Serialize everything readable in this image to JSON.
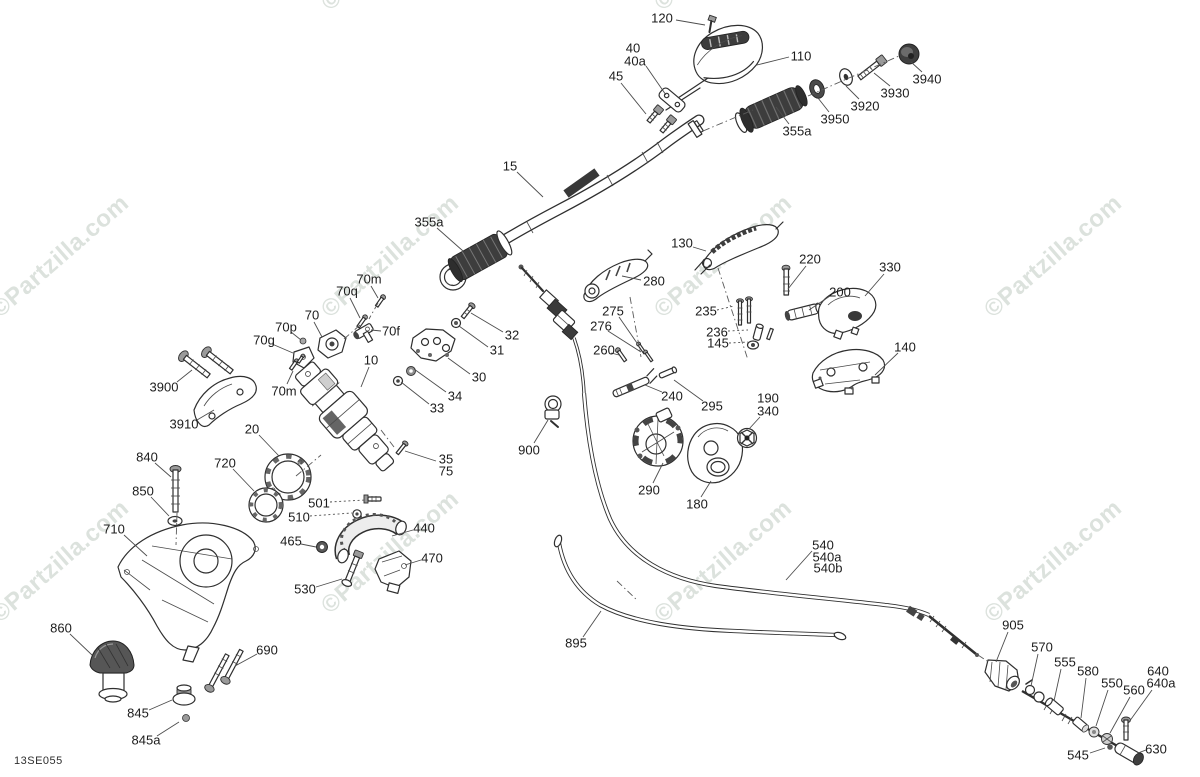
{
  "diagram": {
    "code": "13SE055",
    "title": "Steering system exploded parts diagram",
    "background_color": "#ffffff",
    "line_color": "#2f2f2f",
    "label_color": "#1c1c1c",
    "label_font_px": 13
  },
  "watermark": {
    "text": "©Partzilla.com",
    "color": "#c5cfc7",
    "opacity": 0.6,
    "rotation_deg": -41,
    "font_size": 24,
    "positions": [
      {
        "x": 395,
        "y": -45
      },
      {
        "x": 728,
        "y": -45
      },
      {
        "x": 65,
        "y": 262
      },
      {
        "x": 395,
        "y": 262
      },
      {
        "x": 728,
        "y": 262
      },
      {
        "x": 1058,
        "y": 262
      },
      {
        "x": 65,
        "y": 567
      },
      {
        "x": 395,
        "y": 558
      },
      {
        "x": 728,
        "y": 567
      },
      {
        "x": 1058,
        "y": 567
      }
    ]
  },
  "callouts": [
    {
      "label": "120",
      "x": 662,
      "y": 18,
      "leader": [
        676,
        20,
        705,
        25
      ]
    },
    {
      "label": "40",
      "x": 633,
      "y": 48
    },
    {
      "label": "40a",
      "x": 635,
      "y": 61,
      "leader": [
        646,
        66,
        666,
        95
      ]
    },
    {
      "label": "45",
      "x": 616,
      "y": 76,
      "leader": [
        621,
        83,
        646,
        114
      ]
    },
    {
      "label": "110",
      "x": 801,
      "y": 56,
      "leader": [
        789,
        57,
        757,
        65
      ]
    },
    {
      "label": "3940",
      "x": 927,
      "y": 79,
      "leader": [
        922,
        72,
        911,
        62
      ]
    },
    {
      "label": "3930",
      "x": 895,
      "y": 93,
      "leader": [
        890,
        86,
        874,
        73
      ]
    },
    {
      "label": "3920",
      "x": 865,
      "y": 106,
      "leader": [
        859,
        99,
        846,
        86
      ]
    },
    {
      "label": "3950",
      "x": 835,
      "y": 119,
      "leader": [
        829,
        112,
        818,
        98
      ]
    },
    {
      "label": "355a",
      "x": 797,
      "y": 131,
      "leader": [
        789,
        124,
        776,
        107
      ]
    },
    {
      "label": "15",
      "x": 510,
      "y": 166,
      "leader": [
        517,
        172,
        543,
        197
      ]
    },
    {
      "label": "355a",
      "x": 429,
      "y": 222,
      "leader": [
        437,
        228,
        463,
        251
      ]
    },
    {
      "label": "130",
      "x": 682,
      "y": 243,
      "leader": [
        693,
        247,
        706,
        251
      ]
    },
    {
      "label": "280",
      "x": 654,
      "y": 281,
      "leader": [
        641,
        280,
        622,
        276
      ]
    },
    {
      "label": "220",
      "x": 810,
      "y": 259,
      "leader": [
        806,
        266,
        788,
        289
      ]
    },
    {
      "label": "330",
      "x": 890,
      "y": 267,
      "leader": [
        884,
        274,
        865,
        296
      ]
    },
    {
      "label": "200",
      "x": 840,
      "y": 292,
      "leader": [
        830,
        296,
        809,
        310
      ]
    },
    {
      "label": "235",
      "x": 706,
      "y": 311,
      "leader": [
        717,
        310,
        734,
        306
      ],
      "dotted": true
    },
    {
      "label": "275",
      "x": 613,
      "y": 311,
      "leader": [
        619,
        317,
        637,
        343
      ]
    },
    {
      "label": "276",
      "x": 601,
      "y": 326,
      "leader": [
        608,
        331,
        641,
        352
      ]
    },
    {
      "label": "236",
      "x": 717,
      "y": 332,
      "leader": [
        728,
        331,
        748,
        330
      ],
      "dotted": true
    },
    {
      "label": "145",
      "x": 718,
      "y": 343,
      "leader": [
        729,
        343,
        748,
        342
      ],
      "dotted": true
    },
    {
      "label": "260",
      "x": 604,
      "y": 350,
      "leader": [
        611,
        353,
        619,
        355
      ]
    },
    {
      "label": "140",
      "x": 905,
      "y": 347,
      "leader": [
        898,
        353,
        875,
        375
      ]
    },
    {
      "label": "70m",
      "x": 369,
      "y": 279,
      "leader": [
        371,
        286,
        378,
        298
      ]
    },
    {
      "label": "70q",
      "x": 347,
      "y": 291,
      "leader": [
        350,
        298,
        360,
        318
      ]
    },
    {
      "label": "70",
      "x": 312,
      "y": 315,
      "leader": [
        314,
        322,
        322,
        337
      ]
    },
    {
      "label": "70p",
      "x": 286,
      "y": 327,
      "leader": [
        291,
        332,
        301,
        340
      ]
    },
    {
      "label": "70f",
      "x": 391,
      "y": 331,
      "leader": [
        381,
        331,
        371,
        330
      ]
    },
    {
      "label": "70g",
      "x": 264,
      "y": 340,
      "leader": [
        272,
        344,
        293,
        353
      ]
    },
    {
      "label": "32",
      "x": 512,
      "y": 335,
      "leader": [
        503,
        332,
        471,
        313
      ]
    },
    {
      "label": "31",
      "x": 497,
      "y": 350,
      "leader": [
        488,
        347,
        459,
        326
      ]
    },
    {
      "label": "10",
      "x": 371,
      "y": 360,
      "leader": [
        369,
        367,
        361,
        387
      ]
    },
    {
      "label": "30",
      "x": 479,
      "y": 377,
      "leader": [
        470,
        374,
        448,
        358
      ]
    },
    {
      "label": "3900",
      "x": 164,
      "y": 387,
      "leader": [
        177,
        382,
        192,
        370
      ]
    },
    {
      "label": "70m",
      "x": 284,
      "y": 391,
      "leader": [
        287,
        384,
        293,
        371
      ]
    },
    {
      "label": "34",
      "x": 455,
      "y": 396,
      "leader": [
        446,
        392,
        414,
        369
      ]
    },
    {
      "label": "33",
      "x": 437,
      "y": 408,
      "leader": [
        429,
        404,
        401,
        382
      ]
    },
    {
      "label": "3910",
      "x": 184,
      "y": 424,
      "leader": [
        197,
        420,
        214,
        410
      ]
    },
    {
      "label": "20",
      "x": 252,
      "y": 429,
      "leader": [
        259,
        435,
        279,
        456
      ]
    },
    {
      "label": "240",
      "x": 672,
      "y": 396,
      "leader": [
        662,
        392,
        645,
        385
      ]
    },
    {
      "label": "295",
      "x": 712,
      "y": 406,
      "leader": [
        703,
        401,
        674,
        380
      ]
    },
    {
      "label": "190",
      "x": 768,
      "y": 398
    },
    {
      "label": "340",
      "x": 768,
      "y": 411,
      "leader": [
        760,
        417,
        749,
        429
      ]
    },
    {
      "label": "900",
      "x": 529,
      "y": 450,
      "leader": [
        534,
        443,
        548,
        420
      ]
    },
    {
      "label": "840",
      "x": 147,
      "y": 457,
      "leader": [
        155,
        463,
        171,
        477
      ]
    },
    {
      "label": "720",
      "x": 225,
      "y": 463,
      "leader": [
        233,
        469,
        254,
        491
      ]
    },
    {
      "label": "35",
      "x": 446,
      "y": 459,
      "leader": [
        436,
        461,
        405,
        451
      ]
    },
    {
      "label": "75",
      "x": 446,
      "y": 471
    },
    {
      "label": "850",
      "x": 143,
      "y": 491,
      "leader": [
        151,
        497,
        169,
        516
      ]
    },
    {
      "label": "501",
      "x": 319,
      "y": 503,
      "leader": [
        330,
        502,
        365,
        500
      ],
      "dotted": true
    },
    {
      "label": "510",
      "x": 299,
      "y": 517,
      "leader": [
        310,
        516,
        352,
        513
      ],
      "dotted": true
    },
    {
      "label": "290",
      "x": 649,
      "y": 490,
      "leader": [
        653,
        483,
        663,
        463
      ]
    },
    {
      "label": "180",
      "x": 697,
      "y": 504,
      "leader": [
        701,
        497,
        711,
        481
      ]
    },
    {
      "label": "465",
      "x": 291,
      "y": 541,
      "leader": [
        301,
        544,
        316,
        547
      ]
    },
    {
      "label": "440",
      "x": 424,
      "y": 528,
      "leader": [
        413,
        530,
        392,
        536
      ]
    },
    {
      "label": "710",
      "x": 114,
      "y": 529,
      "leader": [
        124,
        535,
        147,
        556
      ]
    },
    {
      "label": "470",
      "x": 432,
      "y": 558,
      "leader": [
        421,
        560,
        405,
        565
      ]
    },
    {
      "label": "530",
      "x": 305,
      "y": 589,
      "leader": [
        316,
        587,
        342,
        579
      ]
    },
    {
      "label": "540",
      "x": 823,
      "y": 545,
      "leader": [
        812,
        551,
        786,
        580
      ]
    },
    {
      "label": "540a",
      "x": 827,
      "y": 557
    },
    {
      "label": "540b",
      "x": 828,
      "y": 568
    },
    {
      "label": "860",
      "x": 61,
      "y": 628,
      "leader": [
        70,
        634,
        92,
        655
      ]
    },
    {
      "label": "690",
      "x": 267,
      "y": 650,
      "leader": [
        257,
        654,
        235,
        666
      ]
    },
    {
      "label": "895",
      "x": 576,
      "y": 643,
      "leader": [
        583,
        637,
        601,
        611
      ]
    },
    {
      "label": "905",
      "x": 1013,
      "y": 625,
      "leader": [
        1008,
        632,
        996,
        662
      ]
    },
    {
      "label": "570",
      "x": 1042,
      "y": 647,
      "leader": [
        1038,
        654,
        1031,
        686
      ]
    },
    {
      "label": "555",
      "x": 1065,
      "y": 662,
      "leader": [
        1061,
        669,
        1054,
        701
      ]
    },
    {
      "label": "580",
      "x": 1088,
      "y": 671,
      "leader": [
        1086,
        678,
        1081,
        718
      ]
    },
    {
      "label": "550",
      "x": 1112,
      "y": 683,
      "leader": [
        1108,
        690,
        1096,
        726
      ]
    },
    {
      "label": "560",
      "x": 1134,
      "y": 690,
      "leader": [
        1130,
        697,
        1110,
        733
      ]
    },
    {
      "label": "640",
      "x": 1158,
      "y": 671
    },
    {
      "label": "640a",
      "x": 1161,
      "y": 683,
      "leader": [
        1152,
        690,
        1129,
        722
      ]
    },
    {
      "label": "845",
      "x": 138,
      "y": 713,
      "leader": [
        149,
        710,
        172,
        700
      ]
    },
    {
      "label": "845a",
      "x": 146,
      "y": 740,
      "leader": [
        157,
        736,
        179,
        722
      ]
    },
    {
      "label": "630",
      "x": 1156,
      "y": 749,
      "leader": [
        1146,
        750,
        1138,
        753
      ]
    },
    {
      "label": "545",
      "x": 1078,
      "y": 755,
      "leader": [
        1090,
        753,
        1105,
        748
      ]
    }
  ],
  "assembly_lines": [
    [
      703,
      131,
      753,
      110
    ],
    [
      808,
      96,
      899,
      56
    ],
    [
      718,
      268,
      748,
      360
    ],
    [
      630,
      297,
      641,
      357
    ],
    [
      296,
      476,
      321,
      455
    ],
    [
      177,
      513,
      176,
      545
    ],
    [
      978,
      655,
      990,
      663
    ],
    [
      617,
      581,
      638,
      601
    ],
    [
      378,
      303,
      369,
      319
    ],
    [
      360,
      325,
      344,
      339
    ],
    [
      381,
      430,
      394,
      447
    ]
  ]
}
